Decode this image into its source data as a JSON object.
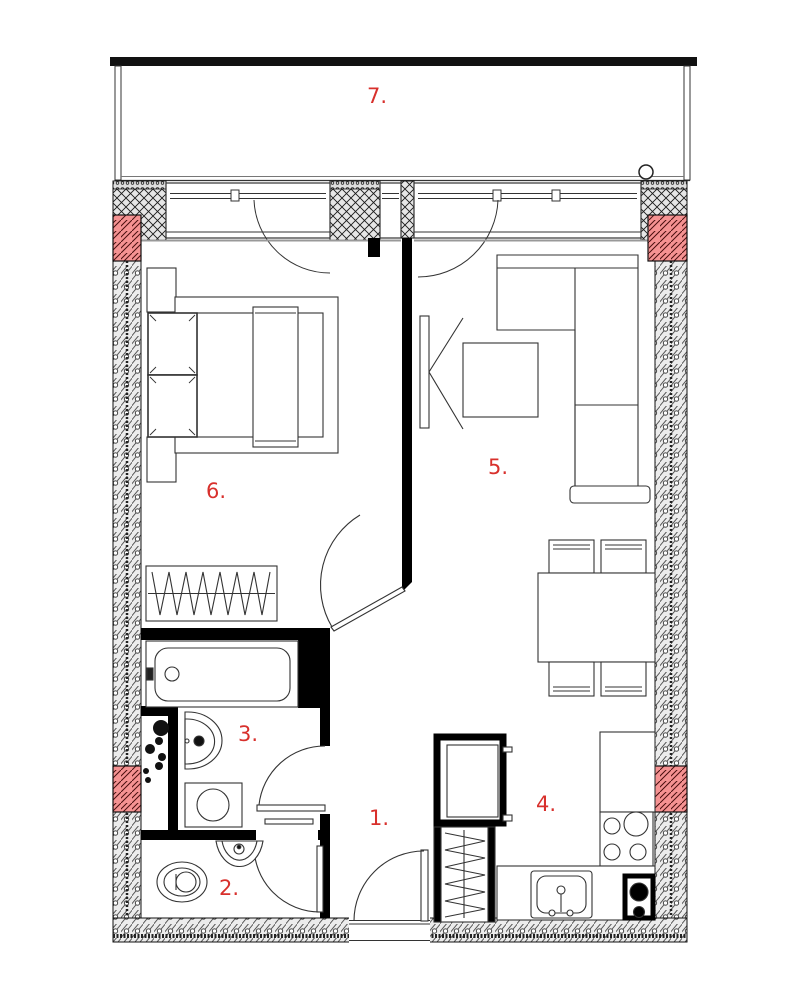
{
  "plan": {
    "rooms": [
      {
        "id": "hall",
        "label": "1."
      },
      {
        "id": "wc",
        "label": "2."
      },
      {
        "id": "bathroom",
        "label": "3."
      },
      {
        "id": "kitchen",
        "label": "4."
      },
      {
        "id": "living-room",
        "label": "5."
      },
      {
        "id": "bedroom",
        "label": "6."
      },
      {
        "id": "balcony",
        "label": "7."
      }
    ],
    "colors": {
      "label": "#d8302c",
      "concrete_column": "#f59292",
      "interior_wall": "#000000",
      "wall_hatch_bg": "#ececec",
      "line": "#333333"
    }
  }
}
